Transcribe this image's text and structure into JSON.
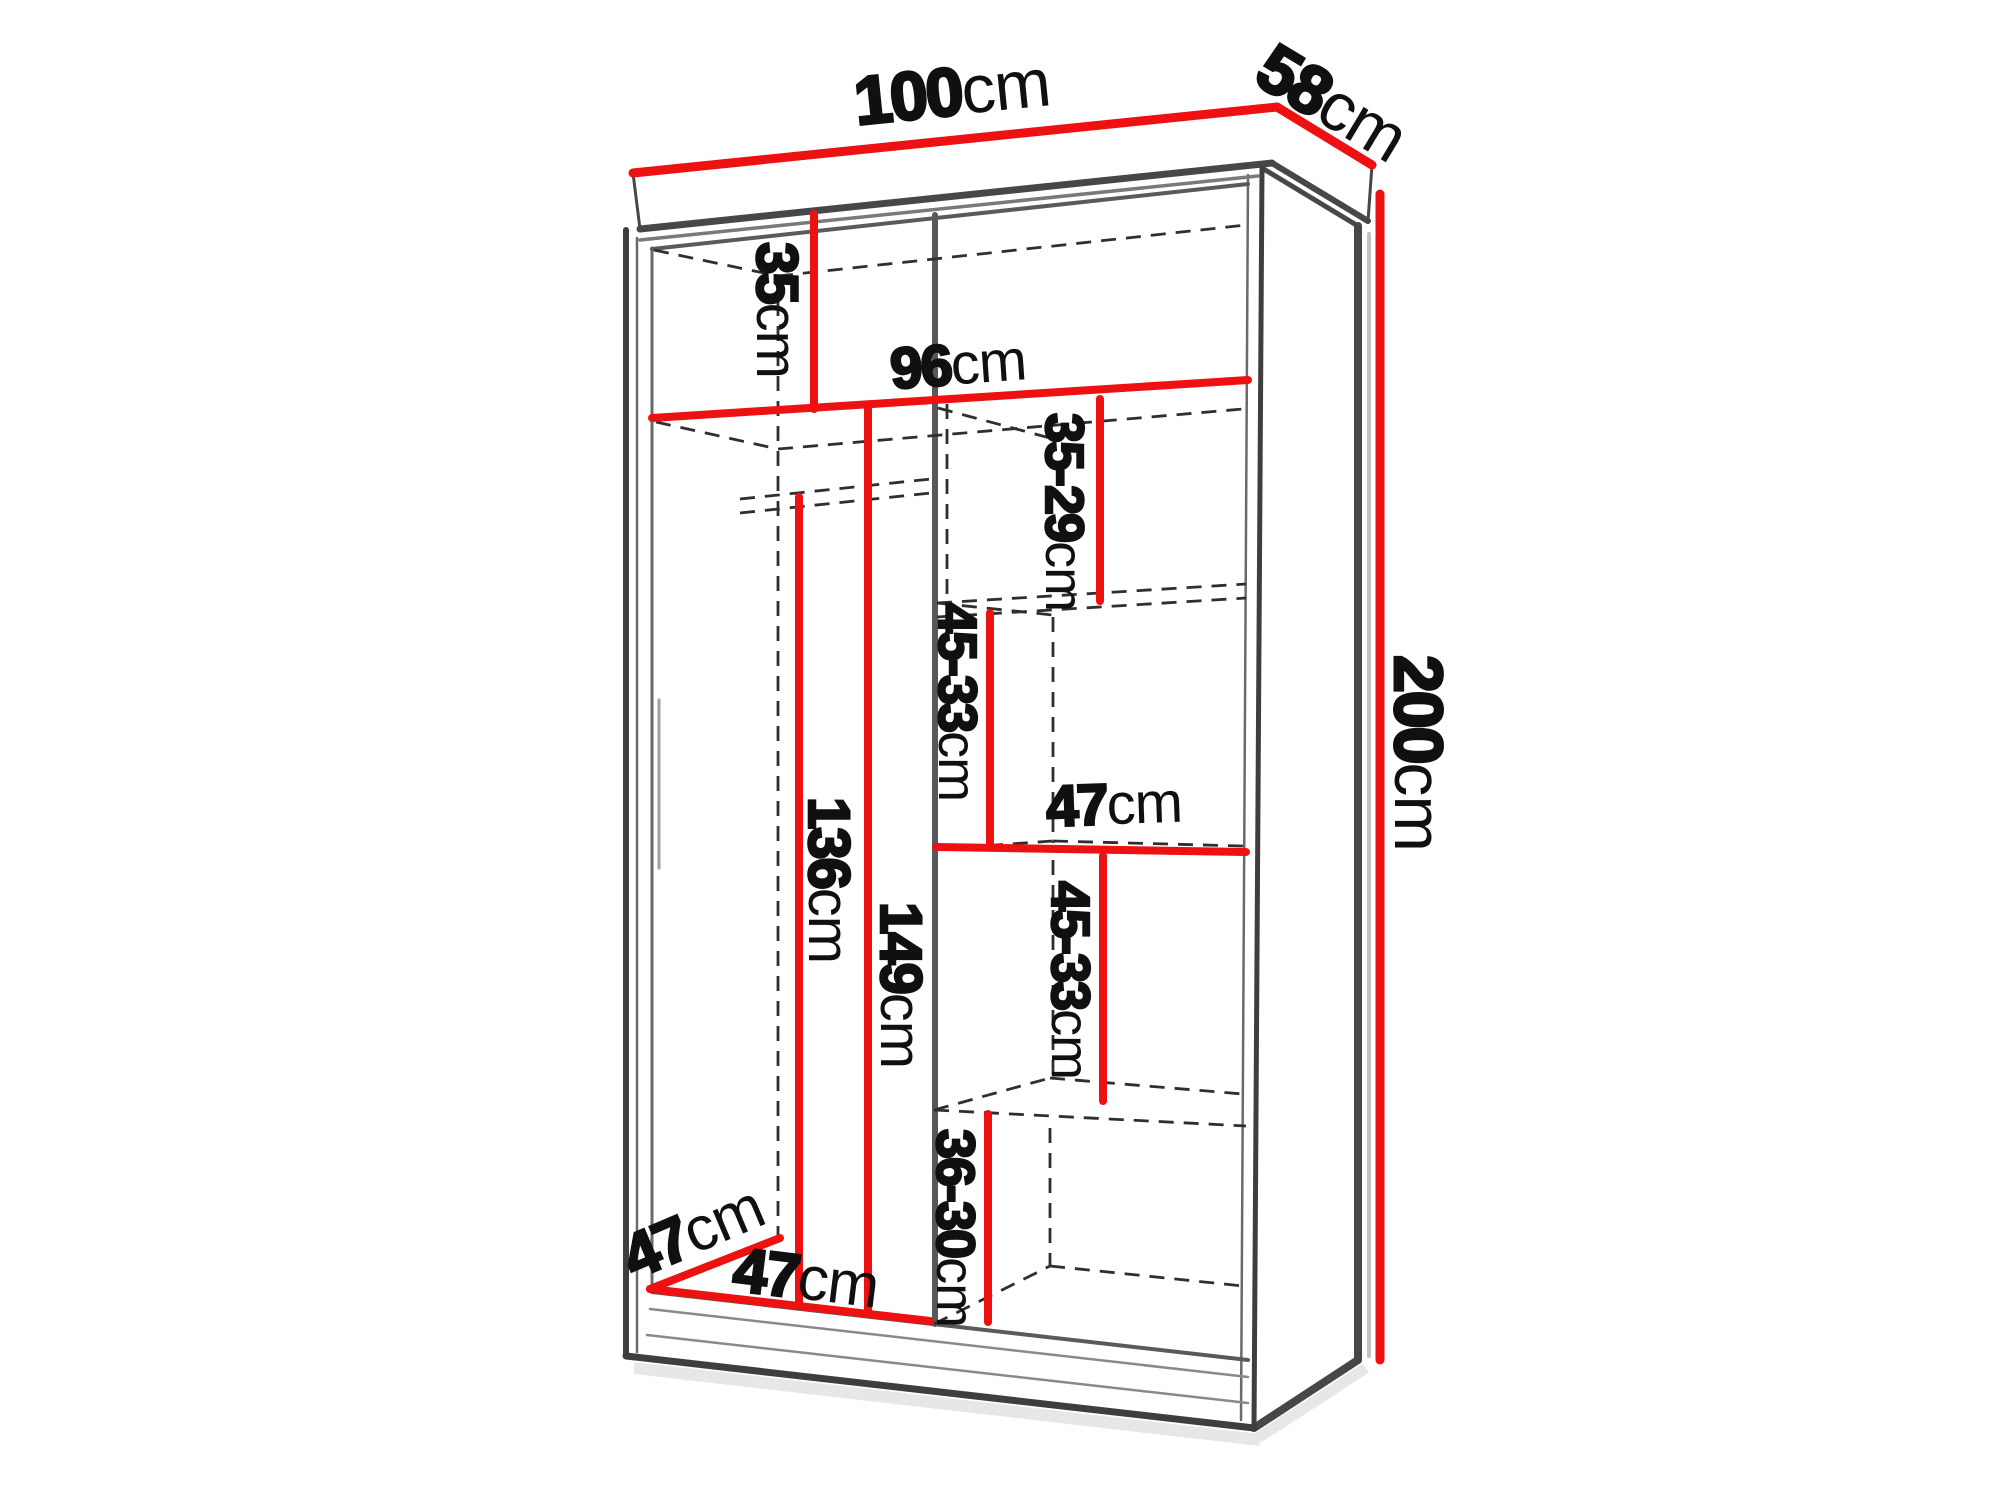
{
  "page": {
    "background": "#ffffff"
  },
  "diagram": {
    "title": "Sliding-door wardrobe interior dimension diagram",
    "units": "cm",
    "accent_color": "#ed1111",
    "outline_color": "#3e3e3e",
    "overall": {
      "width": "100cm",
      "depth": "58cm",
      "height": "200cm"
    },
    "interior": {
      "usable_width": "96cm",
      "top_shelf_drop": "35cm",
      "left_compartment": {
        "width": "47cm",
        "depth": "47cm",
        "rail_drop_height": "136cm",
        "clear_height": "149cm"
      },
      "right_column": {
        "shelf_width": "47cm",
        "top_gap": "35-29cm",
        "upper_gap": "45-33cm",
        "lower_gap": "45-33cm",
        "bottom_gap": "36-30cm"
      }
    },
    "labels": [
      {
        "id": "overall-width",
        "num": "100",
        "unit": "cm",
        "x": 952,
        "y": 92,
        "rotate": -5.8,
        "size": 68,
        "stroke": 3
      },
      {
        "id": "overall-depth",
        "num": "58",
        "unit": "cm",
        "x": 1332,
        "y": 103,
        "rotate": 31,
        "size": 68,
        "stroke": 3
      },
      {
        "id": "overall-height",
        "num": "200",
        "unit": "cm",
        "x": 1418,
        "y": 753,
        "rotate": 90,
        "size": 68,
        "stroke": 3
      },
      {
        "id": "top-shelf-drop",
        "num": "35",
        "unit": "cm",
        "x": 777,
        "y": 310,
        "rotate": 90,
        "size": 58,
        "stroke": 2.6
      },
      {
        "id": "interior-width",
        "num": "96",
        "unit": "cm",
        "x": 958,
        "y": 364,
        "rotate": -4,
        "size": 58,
        "stroke": 2.6
      },
      {
        "id": "gap-top",
        "num": "35-29",
        "unit": "cm",
        "x": 1064,
        "y": 512,
        "rotate": 90,
        "size": 54,
        "stroke": 2.4
      },
      {
        "id": "gap-upper",
        "num": "45-33",
        "unit": "cm",
        "x": 957,
        "y": 702,
        "rotate": 90,
        "size": 54,
        "stroke": 2.4
      },
      {
        "id": "shelf-width",
        "num": "47",
        "unit": "cm",
        "x": 1114,
        "y": 804,
        "rotate": -2,
        "size": 58,
        "stroke": 2.6
      },
      {
        "id": "gap-lower",
        "num": "45-33",
        "unit": "cm",
        "x": 1070,
        "y": 980,
        "rotate": 90,
        "size": 54,
        "stroke": 2.4
      },
      {
        "id": "gap-bottom",
        "num": "36-30",
        "unit": "cm",
        "x": 955,
        "y": 1228,
        "rotate": 90,
        "size": 54,
        "stroke": 2.4
      },
      {
        "id": "rail-height",
        "num": "136",
        "unit": "cm",
        "x": 829,
        "y": 880,
        "rotate": 90,
        "size": 58,
        "stroke": 2.6
      },
      {
        "id": "clear-height",
        "num": "149",
        "unit": "cm",
        "x": 901,
        "y": 985,
        "rotate": 90,
        "size": 58,
        "stroke": 2.6
      },
      {
        "id": "left-depth",
        "num": "47",
        "unit": "cm",
        "x": 693,
        "y": 1232,
        "rotate": -23,
        "size": 62,
        "stroke": 2.8
      },
      {
        "id": "left-width",
        "num": "47",
        "unit": "cm",
        "x": 806,
        "y": 1278,
        "rotate": 7,
        "size": 62,
        "stroke": 2.8
      }
    ]
  }
}
